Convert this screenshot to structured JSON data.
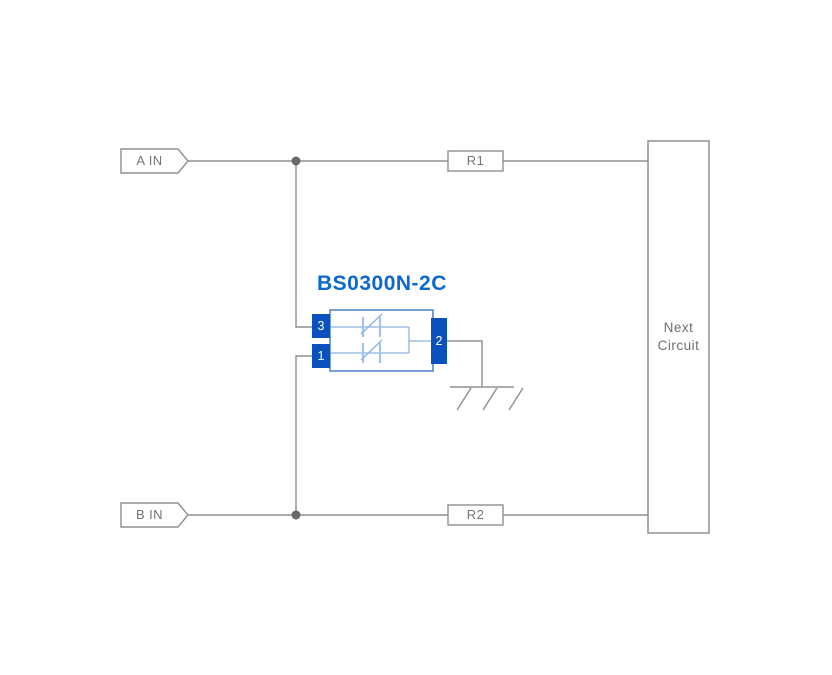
{
  "diagram": {
    "component_title": "BS0300N-2C",
    "input_a": "A IN",
    "input_b": "B IN",
    "resistor_1": "R1",
    "resistor_2": "R2",
    "next_circuit_line1": "Next",
    "next_circuit_line2": "Circuit",
    "pin_top_left": "3",
    "pin_bottom_left": "1",
    "pin_right": "2",
    "colors": {
      "wire_gray": "#8f8f8f",
      "junction_gray": "#6a6a6a",
      "label_gray": "#757575",
      "title_blue": "#0a68d0",
      "pin_blue": "#0b51bd",
      "component_outline_blue": "#4a80c8",
      "inner_wire_blue": "#8fb3e2",
      "diode_bar_blue": "#a3c2ec"
    }
  }
}
